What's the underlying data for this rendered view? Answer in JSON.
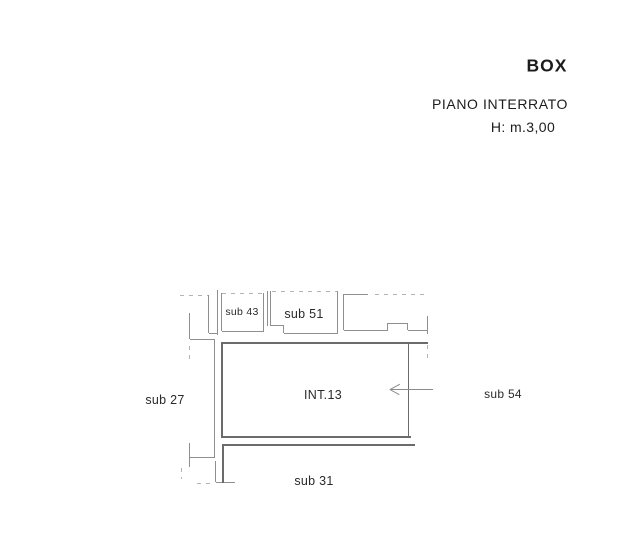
{
  "title_block": {
    "title": "BOX",
    "floor": "PIANO INTERRATO",
    "height_note": "H: m.3,00"
  },
  "plan": {
    "colors": {
      "wall": "#6b6b6b",
      "thin": "#8f8f8f",
      "dash": "#b3b3b3",
      "arrow": "#8c8c8c",
      "text": "#2a2a2a"
    },
    "labels": [
      {
        "id": "sub-43",
        "text": "sub 43",
        "x": 242,
        "y": 312,
        "size": 10.5
      },
      {
        "id": "sub-51",
        "text": "sub 51",
        "x": 304,
        "y": 314,
        "size": 12.5
      },
      {
        "id": "sub-27",
        "text": "sub 27",
        "x": 165,
        "y": 400,
        "size": 12.5
      },
      {
        "id": "int-13",
        "text": "INT.13",
        "x": 323,
        "y": 395,
        "size": 12.5
      },
      {
        "id": "sub-54",
        "text": "sub 54",
        "x": 503,
        "y": 394,
        "size": 12
      },
      {
        "id": "sub-31",
        "text": "sub 31",
        "x": 314,
        "y": 481,
        "size": 12.5
      }
    ],
    "segments": [
      {
        "name": "stair-top-dashed-line",
        "x1": 180,
        "y1": 295,
        "x2": 209,
        "y2": 295,
        "dash": true
      },
      {
        "name": "stair-left-wall",
        "x1": 209,
        "y1": 295,
        "x2": 209,
        "y2": 333
      },
      {
        "name": "stair-bottom-wall",
        "x1": 209,
        "y1": 333,
        "x2": 218,
        "y2": 333
      },
      {
        "name": "stair-right-wall",
        "x1": 218,
        "y1": 290,
        "x2": 218,
        "y2": 335
      },
      {
        "name": "upper-left-wall-vertical",
        "x1": 190,
        "y1": 313,
        "x2": 190,
        "y2": 339
      },
      {
        "name": "upper-left-wall-horizontal",
        "x1": 190,
        "y1": 339,
        "x2": 215,
        "y2": 339
      },
      {
        "name": "left-corridor-wall",
        "x1": 215,
        "y1": 339,
        "x2": 215,
        "y2": 457
      },
      {
        "name": "left-wall-dash-upper",
        "x1": 190,
        "y1": 346,
        "x2": 190,
        "y2": 361,
        "dash": true
      },
      {
        "name": "lower-left-wall-horizontal",
        "x1": 190,
        "y1": 457,
        "x2": 215,
        "y2": 457
      },
      {
        "name": "lower-left-wall-vertical",
        "x1": 190,
        "y1": 443,
        "x2": 190,
        "y2": 467
      },
      {
        "name": "left-wall-dash-lower",
        "x1": 182,
        "y1": 468,
        "x2": 182,
        "y2": 479,
        "dash": true
      },
      {
        "name": "bottom-left-dash",
        "x1": 197,
        "y1": 483,
        "x2": 212,
        "y2": 483,
        "dash": true
      },
      {
        "name": "left-corridor-wall-lower",
        "x1": 216,
        "y1": 461,
        "x2": 216,
        "y2": 482
      },
      {
        "name": "left-corridor-wall-foot",
        "x1": 216,
        "y1": 482,
        "x2": 235,
        "y2": 482
      },
      {
        "name": "sub43-top-dashed",
        "x1": 222,
        "y1": 293,
        "x2": 264,
        "y2": 293,
        "dash": true
      },
      {
        "name": "sub43-left-wall",
        "x1": 222,
        "y1": 293,
        "x2": 222,
        "y2": 331
      },
      {
        "name": "sub43-right-wall",
        "x1": 264,
        "y1": 293,
        "x2": 264,
        "y2": 331
      },
      {
        "name": "sub43-bottom-wall",
        "x1": 222,
        "y1": 331,
        "x2": 264,
        "y2": 331
      },
      {
        "name": "divider-wall-left",
        "x1": 268,
        "y1": 291,
        "x2": 268,
        "y2": 326
      },
      {
        "name": "divider-wall-right",
        "x1": 271,
        "y1": 291,
        "x2": 271,
        "y2": 326
      },
      {
        "name": "sub51-top-dashed",
        "x1": 272,
        "y1": 291,
        "x2": 338,
        "y2": 291,
        "dash": true
      },
      {
        "name": "sub51-step-horizontal",
        "x1": 271,
        "y1": 325,
        "x2": 284,
        "y2": 325
      },
      {
        "name": "sub51-step-vertical",
        "x1": 284,
        "y1": 325,
        "x2": 284,
        "y2": 333
      },
      {
        "name": "sub51-bottom-wall",
        "x1": 284,
        "y1": 333,
        "x2": 338,
        "y2": 333
      },
      {
        "name": "sub51-right-wall",
        "x1": 338,
        "y1": 291,
        "x2": 338,
        "y2": 333
      },
      {
        "name": "neighbor-left-wall",
        "x1": 344,
        "y1": 294,
        "x2": 344,
        "y2": 330
      },
      {
        "name": "neighbor-top-wall",
        "x1": 344,
        "y1": 294,
        "x2": 368,
        "y2": 294
      },
      {
        "name": "neighbor-top-dashed",
        "x1": 375,
        "y1": 294,
        "x2": 428,
        "y2": 294,
        "dash": true
      },
      {
        "name": "neighbor-bottom-wall-left",
        "x1": 344,
        "y1": 330,
        "x2": 388,
        "y2": 330
      },
      {
        "name": "neighbor-step-left",
        "x1": 388,
        "y1": 323,
        "x2": 388,
        "y2": 330
      },
      {
        "name": "neighbor-step-top",
        "x1": 388,
        "y1": 323,
        "x2": 408,
        "y2": 323
      },
      {
        "name": "neighbor-step-right",
        "x1": 408,
        "y1": 323,
        "x2": 408,
        "y2": 330
      },
      {
        "name": "neighbor-bottom-wall-right",
        "x1": 408,
        "y1": 330,
        "x2": 428,
        "y2": 330
      },
      {
        "name": "neighbor-right-wall",
        "x1": 428,
        "y1": 316,
        "x2": 428,
        "y2": 334
      },
      {
        "name": "neighbor-right-dash",
        "x1": 428,
        "y1": 345,
        "x2": 428,
        "y2": 358,
        "dash": true
      },
      {
        "name": "int13-top-wall",
        "x1": 223,
        "y1": 342,
        "x2": 428,
        "y2": 342,
        "t": 2.2,
        "c": "wall"
      },
      {
        "name": "int13-left-wall",
        "x1": 223,
        "y1": 342,
        "x2": 223,
        "y2": 438,
        "t": 2.2,
        "c": "wall"
      },
      {
        "name": "int13-right-wall",
        "x1": 409,
        "y1": 342,
        "x2": 409,
        "y2": 438,
        "t": 1.4,
        "c": "wall"
      },
      {
        "name": "int13-bottom-wall",
        "x1": 223,
        "y1": 436,
        "x2": 411,
        "y2": 436,
        "t": 2.4,
        "c": "wall"
      },
      {
        "name": "sub31-top-boundary",
        "x1": 224,
        "y1": 444,
        "x2": 415,
        "y2": 444,
        "t": 2.2,
        "c": "wall"
      },
      {
        "name": "sub31-left-boundary",
        "x1": 224,
        "y1": 444,
        "x2": 224,
        "y2": 483,
        "t": 1.5,
        "c": "wall"
      },
      {
        "name": "entrance-arrow-shaft",
        "x1": 390,
        "y1": 389,
        "x2": 433,
        "y2": 389,
        "c": "arrow"
      },
      {
        "name": "entrance-arrow-head-upper",
        "x1": 390,
        "y1": 389,
        "x2": 400,
        "y2": 383.5,
        "c": "arrow"
      },
      {
        "name": "entrance-arrow-head-lower",
        "x1": 390,
        "y1": 389,
        "x2": 400,
        "y2": 394.5,
        "c": "arrow"
      }
    ]
  }
}
